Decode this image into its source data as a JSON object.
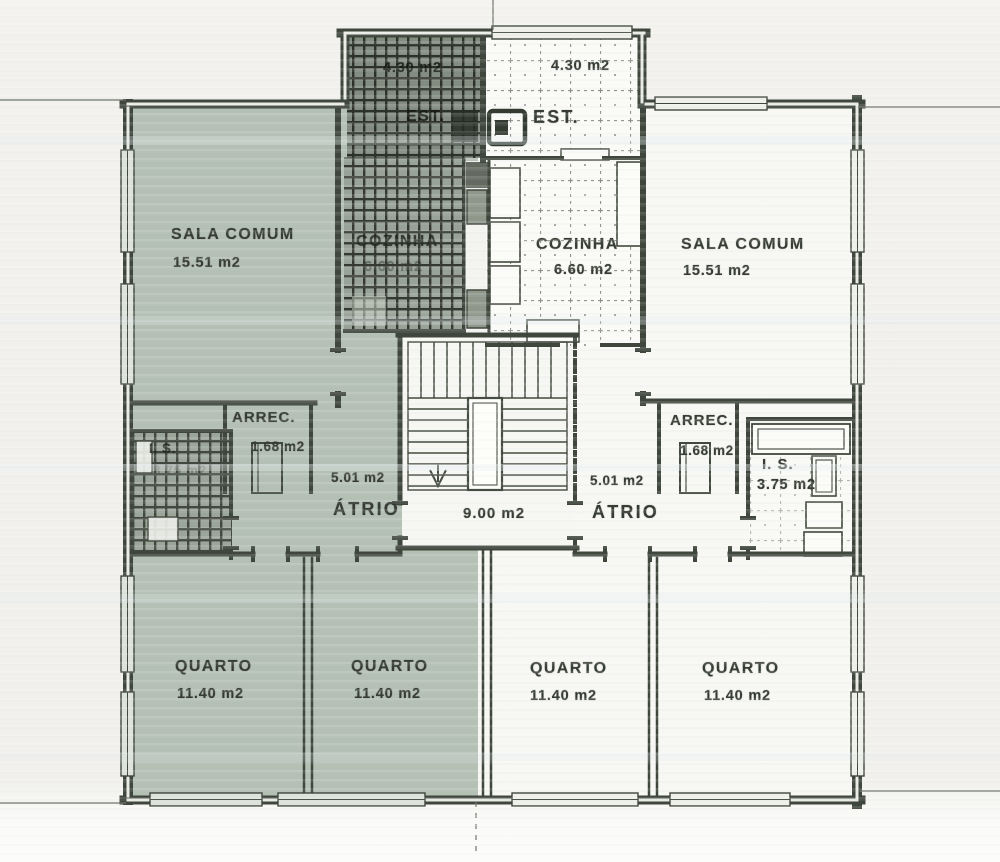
{
  "rooms": {
    "est_left": {
      "label": "EST.",
      "area": "4.30 m2"
    },
    "est_right": {
      "label": "EST.",
      "area": "4.30 m2"
    },
    "cozinha_left": {
      "label": "COZINHA",
      "area": "6.60 m2"
    },
    "cozinha_right": {
      "label": "COZINHA",
      "area": "6.60 m2"
    },
    "sala_left": {
      "label": "SALA COMUM",
      "area": "15.51 m2"
    },
    "sala_right": {
      "label": "SALA COMUM",
      "area": "15.51 m2"
    },
    "arrec_left": {
      "label": "ARREC.",
      "area": "1.68 m2"
    },
    "arrec_right": {
      "label": "ARREC.",
      "area": "1.68 m2"
    },
    "is_left": {
      "label": "I. S.",
      "area": "3.75 m2"
    },
    "is_right": {
      "label": "I. S.",
      "area": "3.75 m2"
    },
    "atrio_left": {
      "label": "ÁTRIO",
      "area": "5.01 m2"
    },
    "atrio_right": {
      "label": "ÁTRIO",
      "area": "5.01 m2"
    },
    "stairwell": {
      "area": "9.00 m2"
    },
    "quarto_left_outer": {
      "label": "QUARTO",
      "area": "11.40 m2"
    },
    "quarto_left_inner": {
      "label": "QUARTO",
      "area": "11.40 m2"
    },
    "quarto_right_inner": {
      "label": "QUARTO",
      "area": "11.40 m2"
    },
    "quarto_right_outer": {
      "label": "QUARTO",
      "area": "11.40 m2"
    }
  },
  "colors": {
    "left_apartment_highlight": "#b4c0b4",
    "wall": "#3f463c",
    "paper": "#f1f0ec"
  }
}
